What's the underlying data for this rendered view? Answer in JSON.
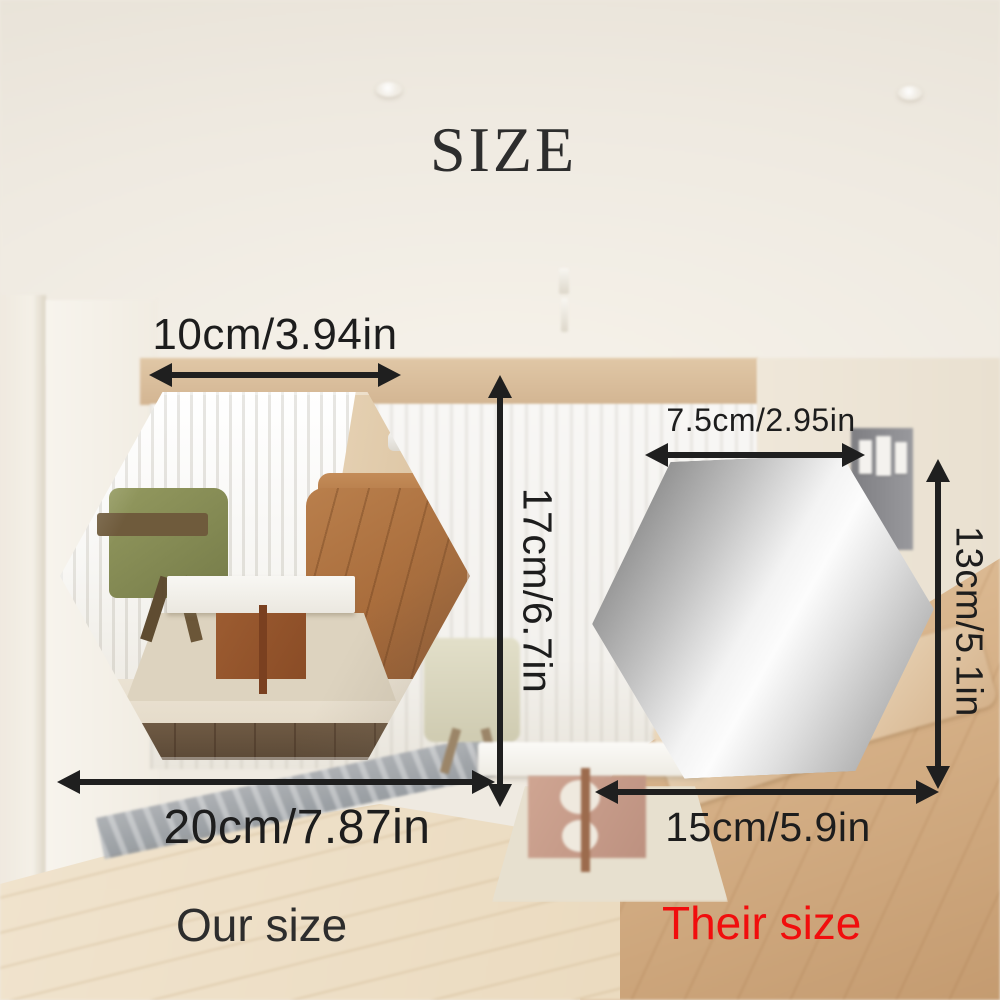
{
  "title": "SIZE",
  "our_mirror": {
    "top_width": "10cm/3.94in",
    "height": "17cm/6.7in",
    "bottom_width": "20cm/7.87in",
    "caption": "Our size"
  },
  "their_mirror": {
    "top_width": "7.5cm/2.95in",
    "height": "13cm/5.1in",
    "bottom_width": "15cm/5.9in",
    "caption": "Their size"
  },
  "colors": {
    "annotation_text": "#1d1d1d",
    "arrow": "#1f1f1f",
    "title_text": "#2d2d2d",
    "our_caption": "#2d2d2d",
    "their_caption": "#f10d0d"
  }
}
